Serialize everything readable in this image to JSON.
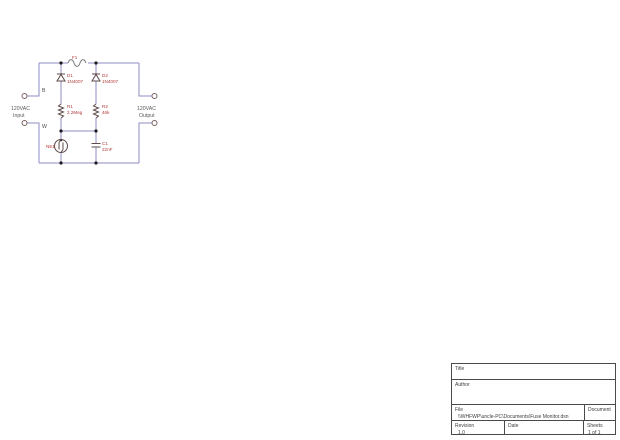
{
  "colors": {
    "wire": "#8d8dc4",
    "symbol": "#5f4a4a",
    "fuse": "#7a7a7a",
    "label_red": "#b33a3a",
    "junction": "#1c1c1c",
    "titleblock_line": "#4a4a4a"
  },
  "schematic": {
    "fuse": {
      "ref": "F1"
    },
    "diode1": {
      "ref": "D1",
      "value": "1N4007"
    },
    "diode2": {
      "ref": "D2",
      "value": "1N4007"
    },
    "resistor1": {
      "ref": "R1",
      "value": "2.2Meg"
    },
    "resistor2": {
      "ref": "R2",
      "value": "46k"
    },
    "neon": {
      "ref": "NE1"
    },
    "capacitor": {
      "ref": "C1",
      "value": "22nF"
    },
    "terminals": {
      "black": "B",
      "white": "W",
      "input_line1": "120VAC",
      "input_line2": "Input",
      "output_line1": "120VAC",
      "output_line2": "Output"
    }
  },
  "titleblock": {
    "title_label": "Title",
    "title_value": "",
    "author_label": "Author",
    "author_value": "",
    "file_label": "File",
    "file_value": "\\\\WHFWP\\uncle-PC\\Documents\\Fuse Monitor.dsn",
    "document_label": "Document",
    "document_value": "",
    "revision_label": "Revision",
    "revision_value": "1.0",
    "date_label": "Date",
    "date_value": "",
    "sheets_label": "Sheets",
    "sheets_value": "1 of 1"
  }
}
